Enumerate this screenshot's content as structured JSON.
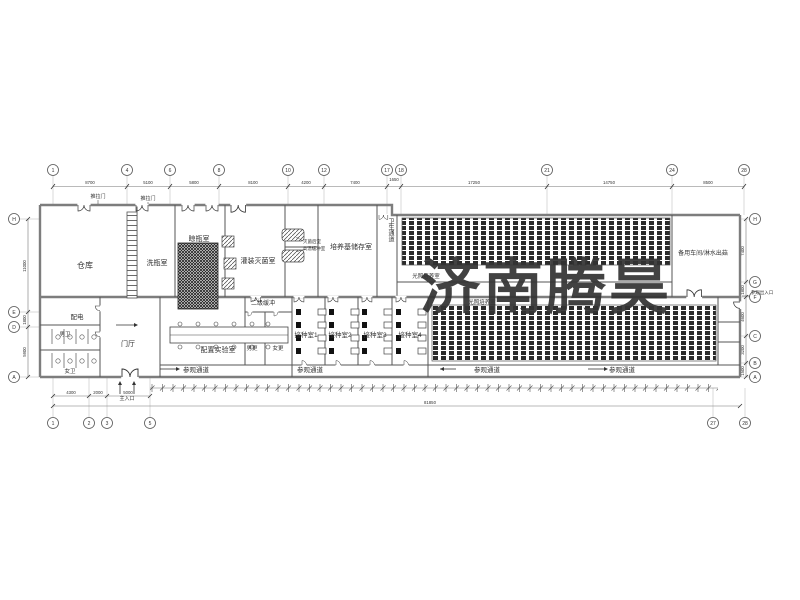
{
  "watermark": {
    "text": "济南腾昊",
    "color": "#e8332a"
  },
  "rooms": {
    "warehouse": "仓库",
    "bottle_wash": "洗瓶室",
    "bottle_dry": "晾瓶室",
    "filling_sterilize": "灌装灭菌室",
    "medium_storage": "培养基储存室",
    "hygiene_corridor": "卫生通道",
    "spare_workshop": "备用车间/淋水出菇",
    "power": "配电",
    "toilet_m": "男卫",
    "toilet_f": "女卫",
    "entrance_hall": "门厅",
    "buffer_2": "二级缓冲",
    "prep_lab": "配置实验室",
    "change_m": "男更",
    "change_f": "女更",
    "inoculation_1": "接种室1",
    "inoculation_2": "接种室2",
    "inoculation_3": "接种室3",
    "inoculation_4": "接种室4",
    "light_culture": "光照培养室",
    "visitor_corridor": "参观通道"
  },
  "annotations": {
    "sliding_door": "推拉门",
    "sterilize_after": "灭菌后室",
    "high_temp_buffer": "高温缓冲室",
    "main_entrance": "主入口",
    "visitor_entrance": "参观出入口"
  },
  "grid": {
    "top": {
      "bubbles": [
        "1",
        "4",
        "6",
        "8",
        "10",
        "12",
        "17",
        "18",
        "21",
        "24",
        "28"
      ],
      "dims": [
        "8700",
        "5100",
        "5800",
        "8100",
        "4200",
        "7400",
        "1650",
        "17250",
        "14750",
        "8500"
      ]
    },
    "bottom": {
      "bubbles": [
        "1",
        "2",
        "3",
        "5",
        "27",
        "28"
      ],
      "dims": [
        "4300",
        "2000",
        "5000"
      ],
      "overall": "81850"
    },
    "left": {
      "bubbles": [
        "H",
        "E",
        "D",
        "A"
      ],
      "dims": [
        "11000",
        "1800",
        "5900"
      ]
    },
    "right": {
      "bubbles": [
        "H",
        "G",
        "F",
        "C",
        "B",
        "A"
      ],
      "dims": [
        "7400",
        "1800",
        "4600",
        "3200",
        "1500"
      ]
    }
  }
}
